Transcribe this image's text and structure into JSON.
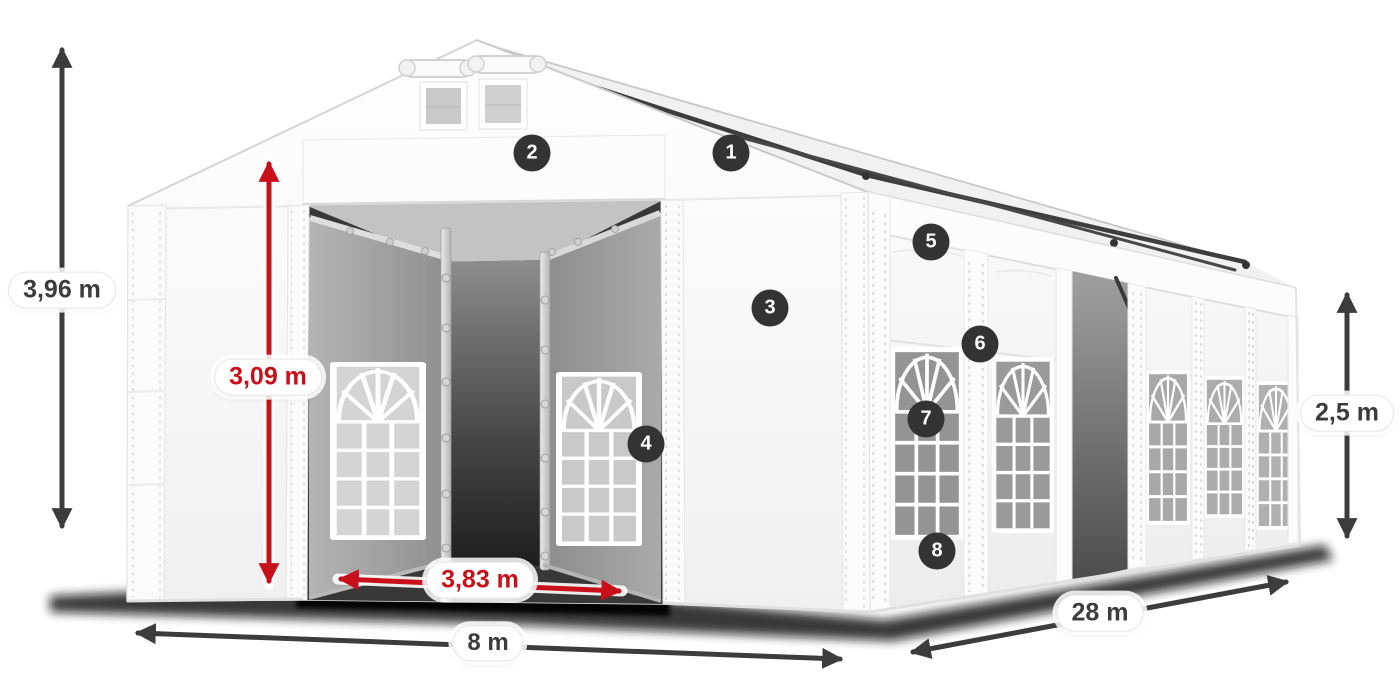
{
  "scene": {
    "description": "Dimensioned illustration of a white storage marquee tent with gable roof, roof ventilation windows, open double front entrance showing interior door panels, arched side windows, side entrance and eight numbered feature callouts",
    "background": "#ffffff"
  },
  "dimensions": {
    "total_height": {
      "value": "3,96 m",
      "style": "dark"
    },
    "entrance_height": {
      "value": "3,09 m",
      "style": "red"
    },
    "entrance_width": {
      "value": "3,83 m",
      "style": "red"
    },
    "front_width": {
      "value": "8 m",
      "style": "dark"
    },
    "side_length": {
      "value": "28 m",
      "style": "dark"
    },
    "wall_height": {
      "value": "2,5 m",
      "style": "dark"
    }
  },
  "callouts": [
    {
      "number": "1"
    },
    {
      "number": "2"
    },
    {
      "number": "3"
    },
    {
      "number": "4"
    },
    {
      "number": "5"
    },
    {
      "number": "6"
    },
    {
      "number": "7"
    },
    {
      "number": "8"
    }
  ],
  "colors": {
    "dimension_arrow_dark": "#3c3c3c",
    "dimension_arrow_red": "#c8101a",
    "badge_background": "#333333",
    "badge_text": "#ffffff",
    "label_background": "#ffffff",
    "tent_fabric": "#f8f8f8",
    "interior_shadow": "#2e2e2e"
  }
}
